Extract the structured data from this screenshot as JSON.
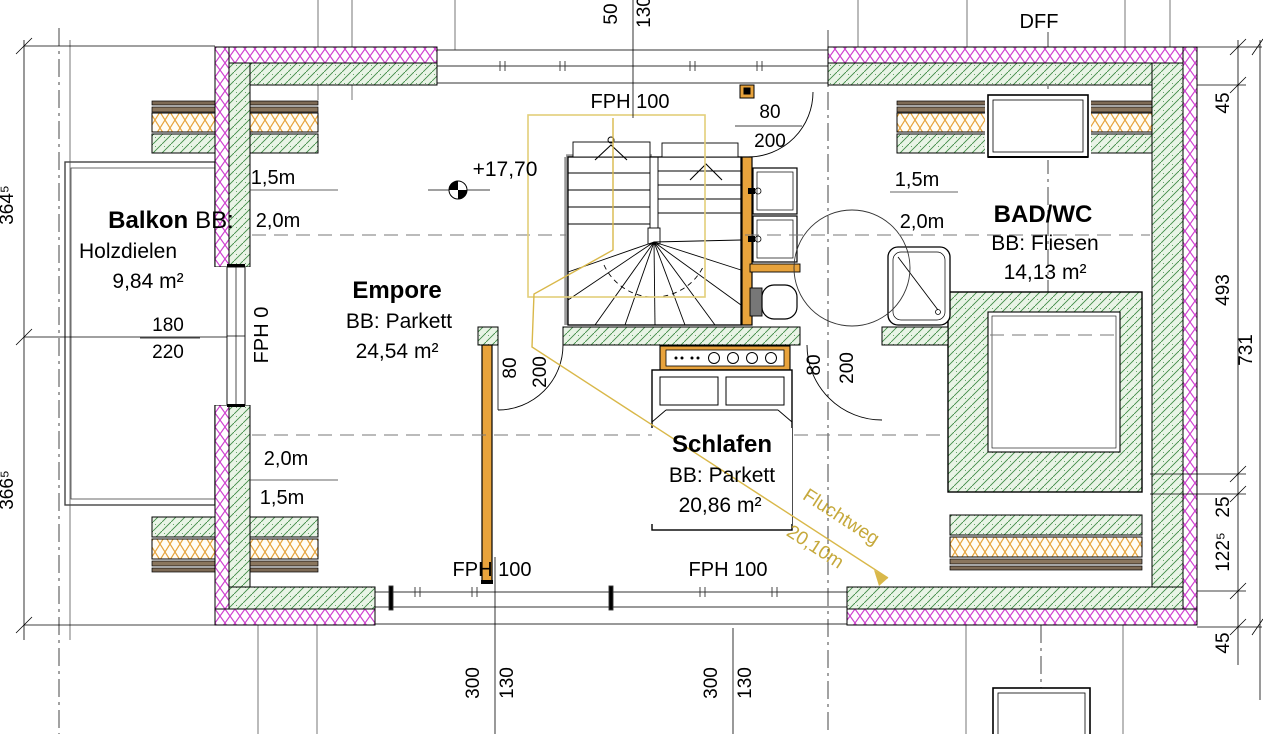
{
  "rooms": {
    "balkon": {
      "name": "Balkon",
      "bb": "BB:",
      "floor": "Holzdielen",
      "area": "9,84 m²"
    },
    "empore": {
      "name": "Empore",
      "bb": "BB: Parkett",
      "area": "24,54 m²"
    },
    "schlafen": {
      "name": "Schlafen",
      "bb": "BB: Parkett",
      "area": "20,86 m²"
    },
    "bad": {
      "name": "BAD/WC",
      "bb": "BB: Fliesen",
      "area": "14,13 m²"
    }
  },
  "labels": {
    "fph100": "FPH 100",
    "fph0": "FPH 0",
    "dff": "DFF",
    "level": "+17,70",
    "fluchtweg": "Fluchtweg",
    "fluchtweg_len": "20,10m"
  },
  "headroom": {
    "h15": "1,5m",
    "h20": "2,0m"
  },
  "doors": {
    "top": {
      "w": "80",
      "h": "200"
    },
    "schlafen": {
      "w": "80",
      "h": "200"
    },
    "bad": {
      "w": "80",
      "h": "200"
    }
  },
  "window_left": {
    "w": "180",
    "h": "220"
  },
  "dims": {
    "left": [
      "364⁵",
      "366⁵"
    ],
    "right": [
      "45",
      "493",
      "25",
      "122⁵",
      "45"
    ],
    "right_total": "731",
    "bottom_left": [
      "300",
      "130"
    ],
    "bottom_right": [
      "300",
      "130"
    ],
    "top": [
      "50",
      "130"
    ]
  },
  "colors": {
    "insulation_outer": "#cf3fd0",
    "wall_hatch": "#3f8b45",
    "insulation_soft": "#e6a33c",
    "wood": "#e8a33c",
    "escape_route": "#d9b84a"
  }
}
